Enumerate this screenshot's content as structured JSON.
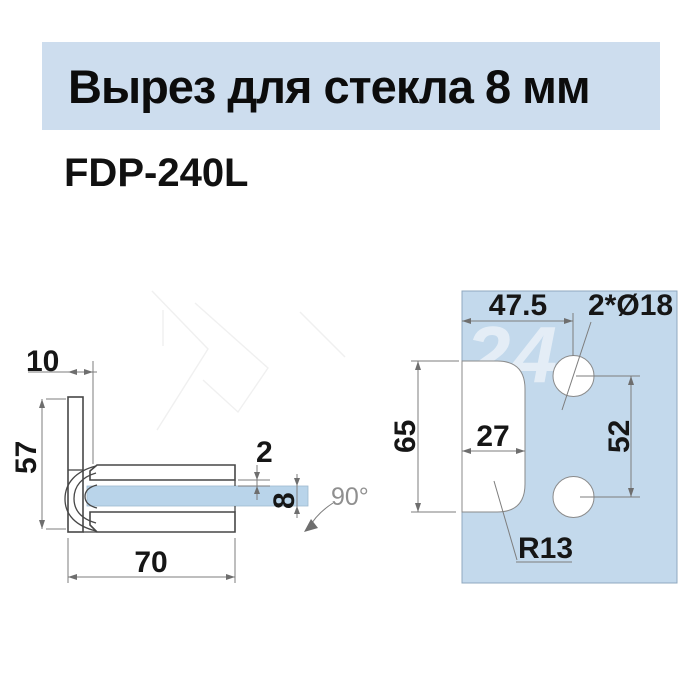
{
  "header": {
    "title": "Вырез для стекла 8 мм",
    "model": "FDP-240L"
  },
  "watermark": "24",
  "colors": {
    "banner_bg": "#cdddee",
    "panel_fill": "#c3d9ec",
    "glass_fill": "#b9d4ea",
    "line": "#474747",
    "dim_line": "#7d7d7d",
    "angle_text": "#8f8f8f"
  },
  "side_view": {
    "dims": {
      "plate_width": "10",
      "height": "57",
      "gasket_gap": "2",
      "glass_thickness": "8",
      "depth": "70",
      "rotation_angle": "90°"
    }
  },
  "cutout_view": {
    "dims": {
      "edge_to_hole": "47.5",
      "holes": "2*Ø18",
      "cutout_height": "65",
      "cutout_depth": "27",
      "hole_spacing": "52",
      "corner_radius": "R13"
    }
  }
}
